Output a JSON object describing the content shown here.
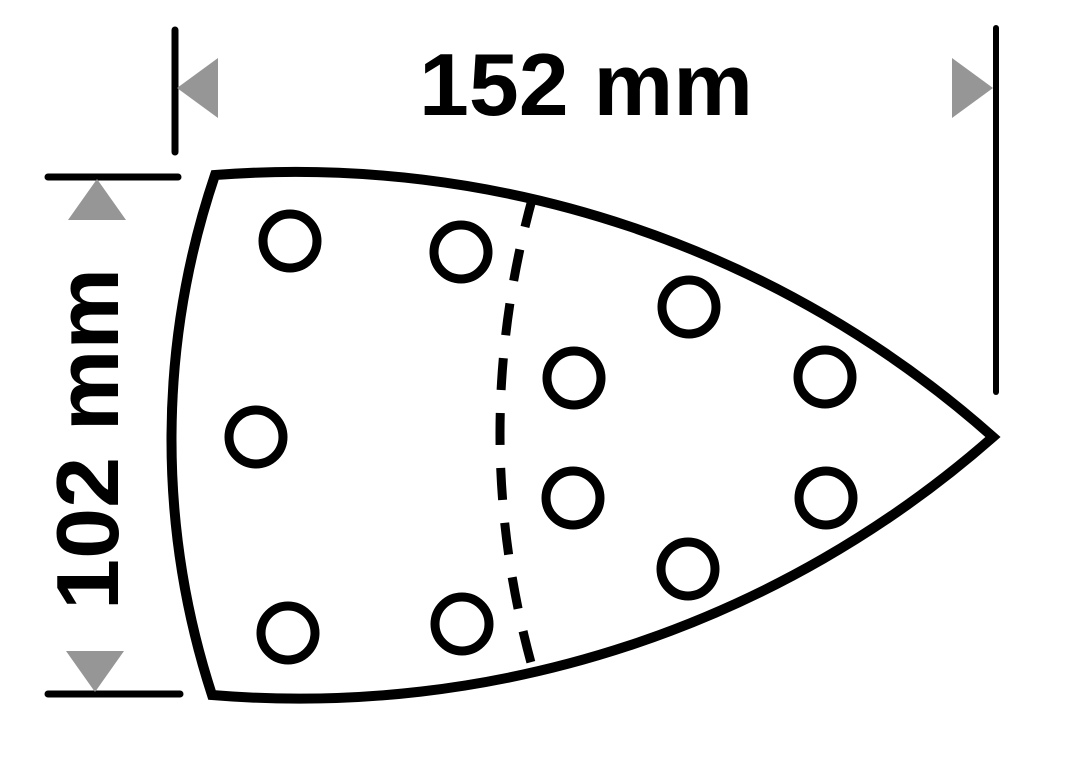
{
  "dimensions": {
    "width": {
      "label": "152 mm"
    },
    "height": {
      "label": "102 mm"
    }
  },
  "colors": {
    "line": "#000000",
    "text": "#000000",
    "arrow": "#969696",
    "background": "#ffffff"
  },
  "holes": [
    {
      "x": 290,
      "y": 241
    },
    {
      "x": 461,
      "y": 252
    },
    {
      "x": 689,
      "y": 307
    },
    {
      "x": 574,
      "y": 378
    },
    {
      "x": 825,
      "y": 377
    },
    {
      "x": 256,
      "y": 437
    },
    {
      "x": 573,
      "y": 498
    },
    {
      "x": 826,
      "y": 498
    },
    {
      "x": 688,
      "y": 569
    },
    {
      "x": 288,
      "y": 633
    },
    {
      "x": 462,
      "y": 624
    }
  ],
  "hole_style": {
    "radius": 27,
    "stroke_width": 9
  }
}
